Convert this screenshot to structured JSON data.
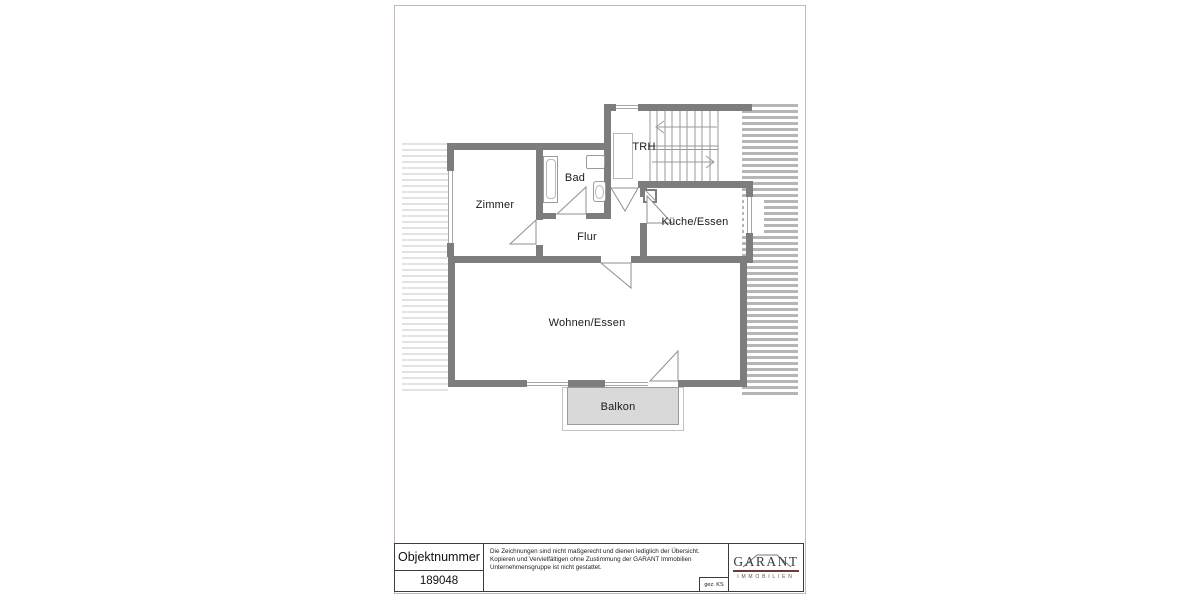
{
  "plan": {
    "wall_color": "#7d7d7d",
    "rooms": {
      "zimmer": "Zimmer",
      "bad": "Bad",
      "trh": "TRH",
      "flur": "Flur",
      "kueche": "Küche/Essen",
      "wohnen": "Wohnen/Essen",
      "balkon": "Balkon"
    }
  },
  "title_block": {
    "label": "Objektnummer",
    "object_number": "189048",
    "disclaimer_lines": [
      "Die Zeichnungen sind nicht maßgerecht und dienen lediglich der Übersicht.",
      "Kopieren und Vervielfältigen ohne Zustimmung der GARANT Immobilien",
      "Unternehmensgruppe ist nicht gestattet."
    ],
    "signed": "gez. KS",
    "logo": {
      "name": "GARANT",
      "subtitle": "IMMOBILIEN",
      "underline_color": "#6e3a3a"
    }
  }
}
